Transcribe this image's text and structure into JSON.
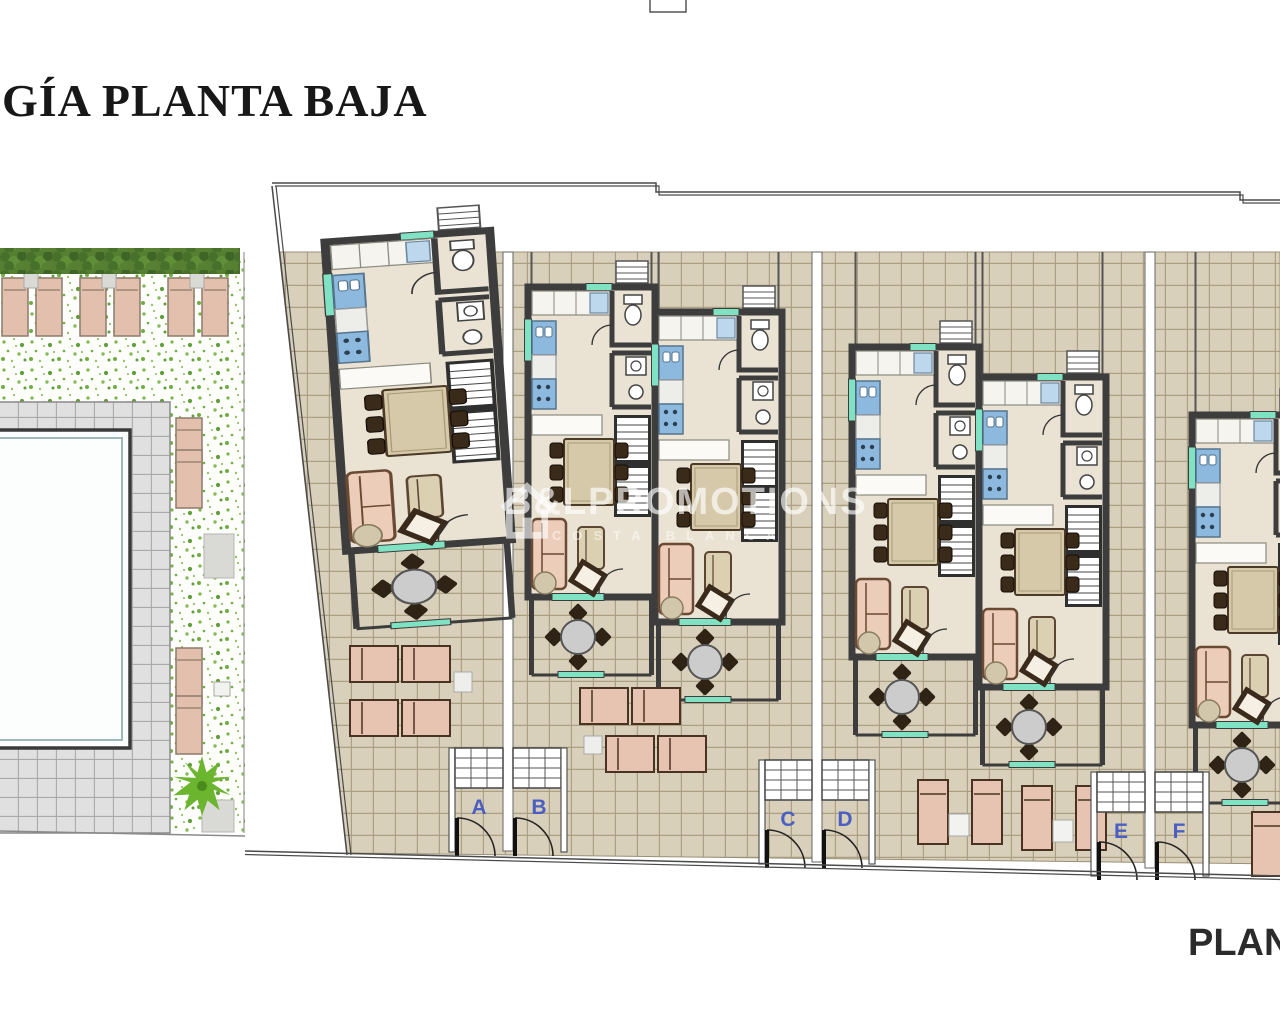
{
  "page": {
    "title": "GÍA PLANTA BAJA",
    "caption": "PLANT"
  },
  "watermark": {
    "brand": "B&LPROMOTIONS",
    "tagline": "COSTA BLANCA"
  },
  "entrances": [
    {
      "label": "A"
    },
    {
      "label": "B"
    },
    {
      "label": "C"
    },
    {
      "label": "D"
    },
    {
      "label": "E"
    },
    {
      "label": "F"
    }
  ],
  "colors": {
    "entrance_label": "#4a5fc0",
    "wall": "#3d3d3d",
    "outdoor_tile": "#d9d0bb",
    "pool_deck": "#e0e0e0",
    "teal_accent": "#7fe3c3",
    "kitchen_blue": "#8cb9dd",
    "sofa_pink": "#ecc9b6",
    "hedge_green": "#567f31",
    "palm_green": "#6cb52e"
  }
}
